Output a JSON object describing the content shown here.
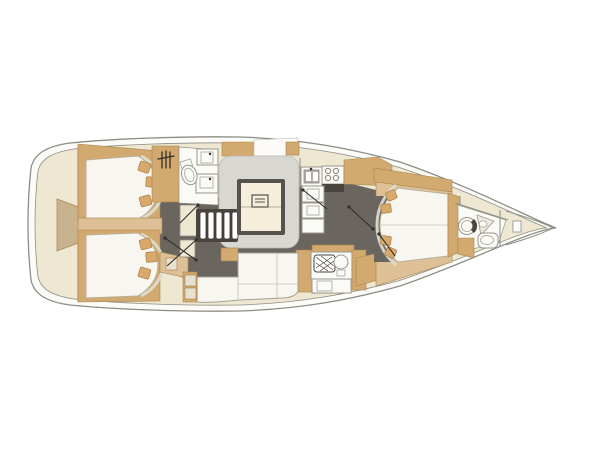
{
  "meta": {
    "title": "Sailing yacht interior layout plan (top view, bow to the right)",
    "kind": "boat-floorplan-drawing"
  },
  "colors": {
    "background": "#ffffff",
    "hull_band": "#fcfbf7",
    "outline": "#8d8d87",
    "deck_cream": "#eee7d1",
    "wood_tan": "#d2a96f",
    "wood_tan_light": "#ddc096",
    "wood_edge": "#a8854f",
    "stern_recess": "#c9b28e",
    "floor_dark": "#6a655e",
    "platform_gray": "#d8d7d2",
    "platform_edge": "#bcbab2",
    "upholstery_white": "#f7f6f1",
    "sofa_edge": "#a6a195",
    "seam": "#c4c0b4",
    "bed_edge": "#b9b09a",
    "shelf_pale": "#dcdfd0",
    "pillow": "#d9a96b",
    "pillow_edge": "#a87f4a",
    "pale_cushion": "#e7e2cf",
    "fixture_white": "#fafaf7",
    "fixture_outline": "#9b968b",
    "table_top": "#f5eedb",
    "table_edge": "#57524c",
    "appliance_dark": "#4a443e",
    "icon_dark": "#332e29"
  },
  "components": {
    "hull": "Hull outline with deck band",
    "stern_platform": "Rounded stern with swim platform recess",
    "aft_cabin_port": "Port aft double cabin with island bed and pillows",
    "aft_cabin_starboard": "Starboard aft double cabin with island bed and pillows",
    "aft_head": "Aft head with shower, toilet and twin-basin vanity",
    "companionway": "Companionway steps down to saloon",
    "saloon": "Saloon seating platform with folding table",
    "saloon_settee": "L-shaped starboard settee with end tables",
    "galley": "Galley with double sink, stove, oven and lockers",
    "nav_station": "Navigation station with hatched chart table and seat",
    "sideboard": "Starboard sideboard lockers",
    "forward_cabin": "Forward owner's cabin with island bed",
    "forward_head": "Forward en-suite head with toilet, corner sink and basin",
    "bow": "Bow section with anchor locker hatch"
  },
  "icons": {
    "shower-icon": "three vertical spray bars with crossing hose line",
    "toilet-icon": "round/oval bowl with rim",
    "sink-icon": "square basin with faucet dot",
    "stove-icon": "four burner circles over dark oven front",
    "chart-table-icon": "cross-hatched rounded rectangle",
    "nav-seat-icon": "circle stool",
    "door-swing-icon": "diagonal line with hinge dots",
    "anchor-hatch-icon": "small outlined rectangle at bow tip"
  }
}
